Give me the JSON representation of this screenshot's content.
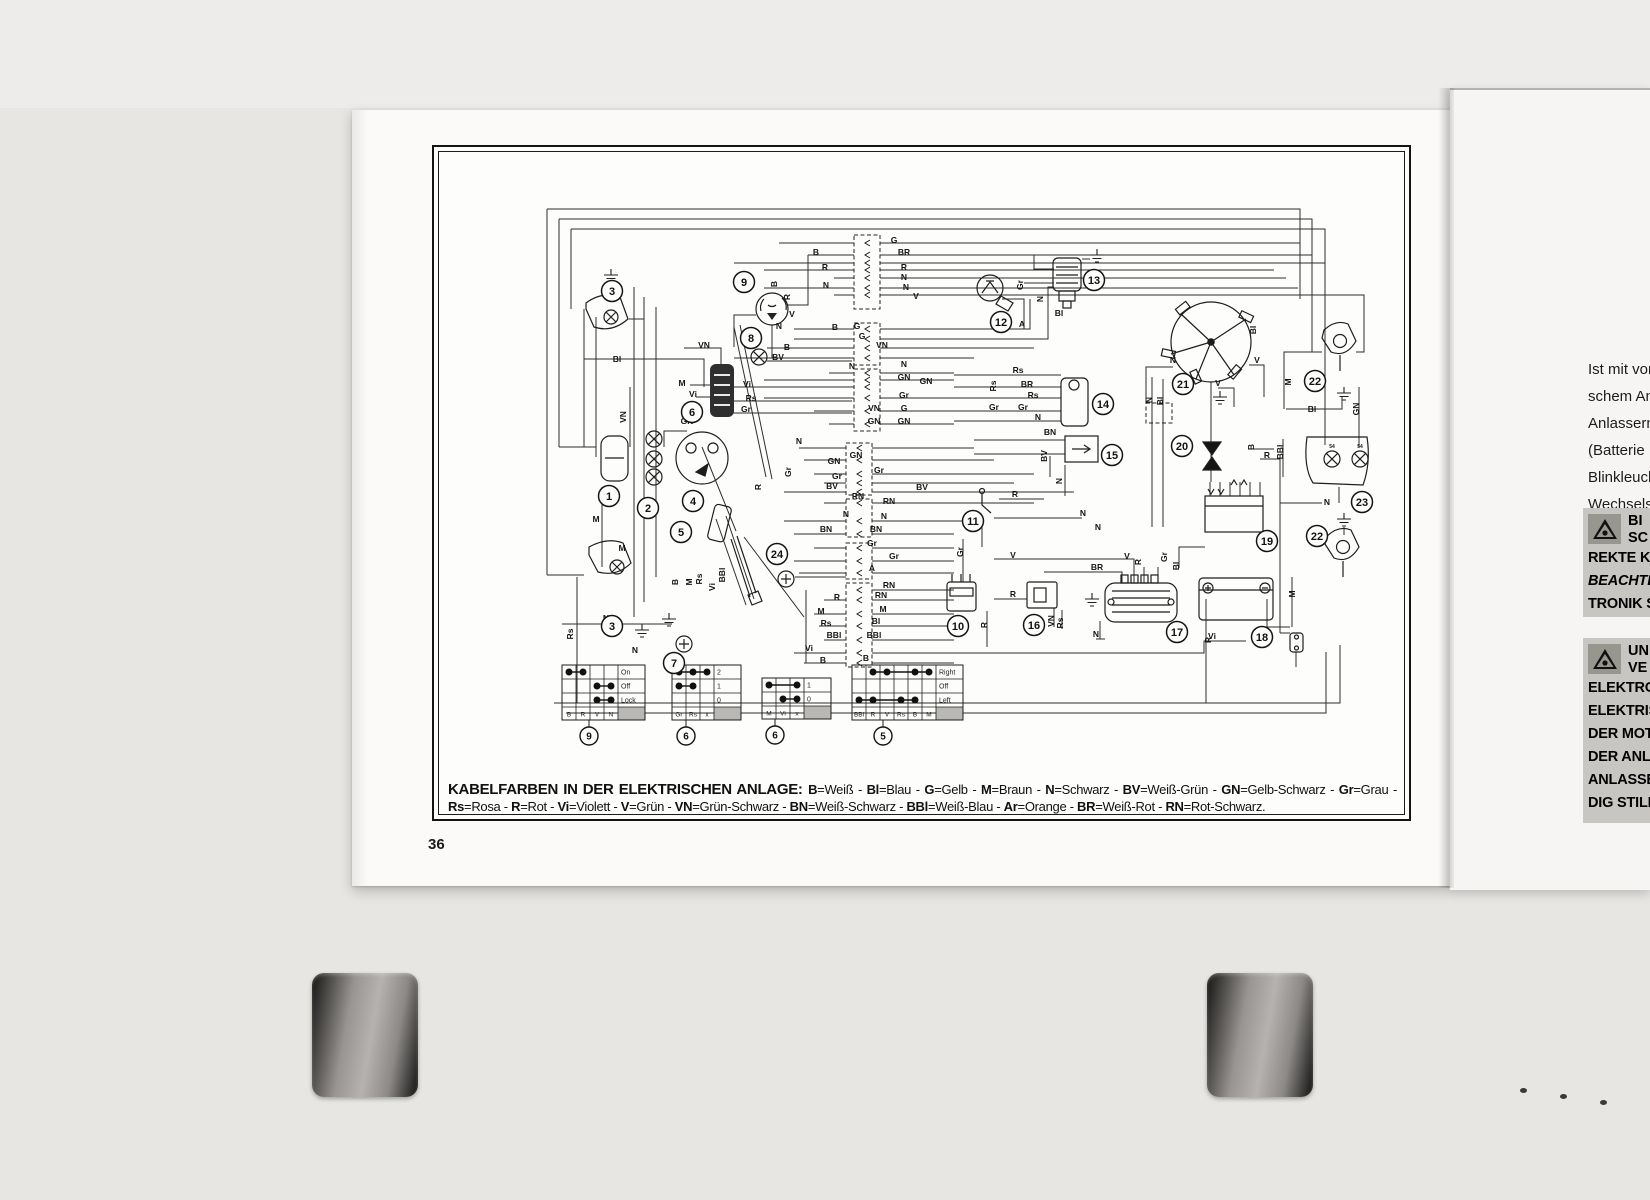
{
  "document": {
    "page_number": "36"
  },
  "diagram": {
    "caption": {
      "heading": "KABELFARBEN IN DER ELEKTRISCHEN ANLAGE:",
      "separator": " - ",
      "terminator": ".",
      "codes": [
        {
          "code": "B",
          "name": "Weiß"
        },
        {
          "code": "Bl",
          "name": "Blau"
        },
        {
          "code": "G",
          "name": "Gelb"
        },
        {
          "code": "M",
          "name": "Braun"
        },
        {
          "code": "N",
          "name": "Schwarz"
        },
        {
          "code": "BV",
          "name": "Weiß-Grün"
        },
        {
          "code": "GN",
          "name": "Gelb-Schwarz"
        },
        {
          "code": "Gr",
          "name": "Grau"
        },
        {
          "code": "Rs",
          "name": "Rosa"
        },
        {
          "code": "R",
          "name": "Rot"
        },
        {
          "code": "Vi",
          "name": "Violett"
        },
        {
          "code": "V",
          "name": "Grün"
        },
        {
          "code": "VN",
          "name": "Grün-Schwarz"
        },
        {
          "code": "BN",
          "name": "Weiß-Schwarz"
        },
        {
          "code": "BBl",
          "name": "Weiß-Blau"
        },
        {
          "code": "Ar",
          "name": "Orange"
        },
        {
          "code": "BR",
          "name": "Weiß-Rot"
        },
        {
          "code": "RN",
          "name": "Rot-Schwarz"
        }
      ]
    },
    "component_markers": [
      {
        "n": "1",
        "x": 175,
        "y": 349
      },
      {
        "n": "2",
        "x": 214,
        "y": 361
      },
      {
        "n": "3",
        "x": 178,
        "y": 144
      },
      {
        "n": "3",
        "x": 178,
        "y": 479
      },
      {
        "n": "4",
        "x": 259,
        "y": 354
      },
      {
        "n": "5",
        "x": 247,
        "y": 385
      },
      {
        "n": "6",
        "x": 258,
        "y": 265
      },
      {
        "n": "7",
        "x": 240,
        "y": 516
      },
      {
        "n": "8",
        "x": 317,
        "y": 191
      },
      {
        "n": "9",
        "x": 310,
        "y": 135
      },
      {
        "n": "10",
        "x": 524,
        "y": 479
      },
      {
        "n": "11",
        "x": 539,
        "y": 374
      },
      {
        "n": "12",
        "x": 567,
        "y": 175
      },
      {
        "n": "13",
        "x": 660,
        "y": 133
      },
      {
        "n": "14",
        "x": 669,
        "y": 257
      },
      {
        "n": "15",
        "x": 678,
        "y": 308
      },
      {
        "n": "16",
        "x": 600,
        "y": 478
      },
      {
        "n": "17",
        "x": 743,
        "y": 485
      },
      {
        "n": "18",
        "x": 828,
        "y": 490
      },
      {
        "n": "19",
        "x": 833,
        "y": 394
      },
      {
        "n": "20",
        "x": 748,
        "y": 299
      },
      {
        "n": "21",
        "x": 749,
        "y": 237
      },
      {
        "n": "22",
        "x": 881,
        "y": 234
      },
      {
        "n": "22",
        "x": 883,
        "y": 389
      },
      {
        "n": "23",
        "x": 928,
        "y": 355
      },
      {
        "n": "24",
        "x": 343,
        "y": 407
      }
    ],
    "wire_labels": [
      {
        "t": "Bl",
        "x": 183,
        "y": 215
      },
      {
        "t": "VN",
        "x": 192,
        "y": 270,
        "v": 1
      },
      {
        "t": "M",
        "x": 162,
        "y": 375
      },
      {
        "t": "Rs",
        "x": 139,
        "y": 487,
        "v": 1
      },
      {
        "t": "N",
        "x": 172,
        "y": 474
      },
      {
        "t": "M",
        "x": 188,
        "y": 404
      },
      {
        "t": "N",
        "x": 201,
        "y": 506
      },
      {
        "t": "VN",
        "x": 270,
        "y": 201
      },
      {
        "t": "M",
        "x": 248,
        "y": 239
      },
      {
        "t": "Vi",
        "x": 259,
        "y": 250
      },
      {
        "t": "Vi",
        "x": 313,
        "y": 240
      },
      {
        "t": "Rs",
        "x": 317,
        "y": 254
      },
      {
        "t": "Gr",
        "x": 312,
        "y": 265
      },
      {
        "t": "GN",
        "x": 253,
        "y": 277
      },
      {
        "t": "B",
        "x": 244,
        "y": 435,
        "v": 1
      },
      {
        "t": "Rs",
        "x": 268,
        "y": 432,
        "v": 1
      },
      {
        "t": "Vi",
        "x": 281,
        "y": 440,
        "v": 1
      },
      {
        "t": "BBl",
        "x": 291,
        "y": 428,
        "v": 1
      },
      {
        "t": "M",
        "x": 258,
        "y": 435,
        "v": 1
      },
      {
        "t": "R",
        "x": 327,
        "y": 340,
        "v": 1
      },
      {
        "t": "Gr",
        "x": 357,
        "y": 325,
        "v": 1
      },
      {
        "t": "B",
        "x": 343,
        "y": 137,
        "v": 1
      },
      {
        "t": "R",
        "x": 356,
        "y": 150,
        "v": 1
      },
      {
        "t": "G",
        "x": 460,
        "y": 96
      },
      {
        "t": "B",
        "x": 382,
        "y": 108
      },
      {
        "t": "BR",
        "x": 470,
        "y": 108
      },
      {
        "t": "R",
        "x": 391,
        "y": 123
      },
      {
        "t": "R",
        "x": 470,
        "y": 123
      },
      {
        "t": "N",
        "x": 470,
        "y": 133
      },
      {
        "t": "N",
        "x": 392,
        "y": 141
      },
      {
        "t": "N",
        "x": 472,
        "y": 143
      },
      {
        "t": "V",
        "x": 482,
        "y": 152
      },
      {
        "t": "V",
        "x": 358,
        "y": 170
      },
      {
        "t": "N",
        "x": 345,
        "y": 182
      },
      {
        "t": "B",
        "x": 401,
        "y": 183
      },
      {
        "t": "G",
        "x": 423,
        "y": 182
      },
      {
        "t": "G",
        "x": 428,
        "y": 192
      },
      {
        "t": "VN",
        "x": 448,
        "y": 201
      },
      {
        "t": "B",
        "x": 353,
        "y": 203
      },
      {
        "t": "BV",
        "x": 344,
        "y": 213
      },
      {
        "t": "N",
        "x": 418,
        "y": 222
      },
      {
        "t": "N",
        "x": 470,
        "y": 220
      },
      {
        "t": "GN",
        "x": 470,
        "y": 233
      },
      {
        "t": "GN",
        "x": 492,
        "y": 237
      },
      {
        "t": "Gr",
        "x": 470,
        "y": 251
      },
      {
        "t": "VN",
        "x": 440,
        "y": 264
      },
      {
        "t": "G",
        "x": 470,
        "y": 264
      },
      {
        "t": "GN",
        "x": 440,
        "y": 277
      },
      {
        "t": "GN",
        "x": 470,
        "y": 277
      },
      {
        "t": "N",
        "x": 365,
        "y": 297
      },
      {
        "t": "GN",
        "x": 400,
        "y": 317
      },
      {
        "t": "GN",
        "x": 422,
        "y": 311
      },
      {
        "t": "Gr",
        "x": 403,
        "y": 332
      },
      {
        "t": "Gr",
        "x": 445,
        "y": 326
      },
      {
        "t": "BV",
        "x": 398,
        "y": 342
      },
      {
        "t": "BV",
        "x": 488,
        "y": 343
      },
      {
        "t": "RN",
        "x": 424,
        "y": 352
      },
      {
        "t": "RN",
        "x": 455,
        "y": 357
      },
      {
        "t": "N",
        "x": 412,
        "y": 370
      },
      {
        "t": "N",
        "x": 450,
        "y": 372
      },
      {
        "t": "BN",
        "x": 392,
        "y": 385
      },
      {
        "t": "BN",
        "x": 442,
        "y": 385
      },
      {
        "t": "Gr",
        "x": 438,
        "y": 399
      },
      {
        "t": "Gr",
        "x": 460,
        "y": 412
      },
      {
        "t": "A",
        "x": 438,
        "y": 424
      },
      {
        "t": "RN",
        "x": 455,
        "y": 441
      },
      {
        "t": "R",
        "x": 403,
        "y": 453
      },
      {
        "t": "RN",
        "x": 447,
        "y": 451
      },
      {
        "t": "M",
        "x": 387,
        "y": 467
      },
      {
        "t": "M",
        "x": 449,
        "y": 465
      },
      {
        "t": "Rs",
        "x": 392,
        "y": 479
      },
      {
        "t": "Bl",
        "x": 442,
        "y": 477
      },
      {
        "t": "BBl",
        "x": 400,
        "y": 491
      },
      {
        "t": "BBl",
        "x": 440,
        "y": 491
      },
      {
        "t": "Vi",
        "x": 375,
        "y": 504
      },
      {
        "t": "B",
        "x": 389,
        "y": 516
      },
      {
        "t": "B",
        "x": 432,
        "y": 514
      },
      {
        "t": "Gr",
        "x": 589,
        "y": 138,
        "v": 1
      },
      {
        "t": "N",
        "x": 609,
        "y": 152,
        "v": 1
      },
      {
        "t": "Bl",
        "x": 625,
        "y": 169
      },
      {
        "t": "A",
        "x": 588,
        "y": 180
      },
      {
        "t": "Rs",
        "x": 584,
        "y": 226
      },
      {
        "t": "Rs",
        "x": 562,
        "y": 239,
        "v": 1
      },
      {
        "t": "BR",
        "x": 593,
        "y": 240
      },
      {
        "t": "Rs",
        "x": 599,
        "y": 251
      },
      {
        "t": "Gr",
        "x": 560,
        "y": 263
      },
      {
        "t": "Gr",
        "x": 589,
        "y": 263
      },
      {
        "t": "N",
        "x": 604,
        "y": 273
      },
      {
        "t": "BN",
        "x": 616,
        "y": 288
      },
      {
        "t": "BV",
        "x": 613,
        "y": 309,
        "v": 1
      },
      {
        "t": "N",
        "x": 628,
        "y": 334,
        "v": 1
      },
      {
        "t": "R",
        "x": 581,
        "y": 350
      },
      {
        "t": "N",
        "x": 649,
        "y": 369
      },
      {
        "t": "N",
        "x": 664,
        "y": 383
      },
      {
        "t": "Gr",
        "x": 529,
        "y": 405,
        "v": 1
      },
      {
        "t": "V",
        "x": 579,
        "y": 411
      },
      {
        "t": "V",
        "x": 693,
        "y": 412
      },
      {
        "t": "R",
        "x": 707,
        "y": 415,
        "v": 1
      },
      {
        "t": "Gr",
        "x": 733,
        "y": 410,
        "v": 1
      },
      {
        "t": "BR",
        "x": 663,
        "y": 423
      },
      {
        "t": "Bl",
        "x": 745,
        "y": 419,
        "v": 1
      },
      {
        "t": "R",
        "x": 579,
        "y": 450
      },
      {
        "t": "R",
        "x": 553,
        "y": 478,
        "v": 1
      },
      {
        "t": "VN",
        "x": 620,
        "y": 474,
        "v": 1
      },
      {
        "t": "Rs",
        "x": 629,
        "y": 476,
        "v": 1
      },
      {
        "t": "N",
        "x": 662,
        "y": 490
      },
      {
        "t": "R",
        "x": 777,
        "y": 493,
        "v": 1
      },
      {
        "t": "B",
        "x": 820,
        "y": 300,
        "v": 1
      },
      {
        "t": "R",
        "x": 833,
        "y": 311
      },
      {
        "t": "N",
        "x": 739,
        "y": 216
      },
      {
        "t": "V",
        "x": 823,
        "y": 216
      },
      {
        "t": "V",
        "x": 784,
        "y": 239
      },
      {
        "t": "Bl",
        "x": 822,
        "y": 183,
        "v": 1
      },
      {
        "t": "M",
        "x": 857,
        "y": 235,
        "v": 1
      },
      {
        "t": "Bl",
        "x": 878,
        "y": 265
      },
      {
        "t": "GN",
        "x": 925,
        "y": 262,
        "v": 1
      },
      {
        "t": "BBl",
        "x": 849,
        "y": 305,
        "v": 1
      },
      {
        "t": "N",
        "x": 893,
        "y": 358
      },
      {
        "t": "M",
        "x": 861,
        "y": 447,
        "v": 1
      },
      {
        "t": "N",
        "x": 718,
        "y": 253,
        "v": 1
      },
      {
        "t": "Bl",
        "x": 729,
        "y": 254,
        "v": 1
      },
      {
        "t": "Vi",
        "x": 778,
        "y": 492
      },
      {
        "t": "54",
        "x": 898,
        "y": 301,
        "s": 5
      },
      {
        "t": "54",
        "x": 926,
        "y": 301,
        "s": 5
      }
    ],
    "legend_tables": [
      {
        "x": 128,
        "y": 518,
        "cols": [
          "B",
          "R",
          "V",
          "N"
        ],
        "rows": [
          {
            "label": "On",
            "dots": [
              0,
              1
            ]
          },
          {
            "label": "Off",
            "dots": [
              2,
              3
            ]
          },
          {
            "label": "Lock",
            "dots": [
              2,
              3
            ]
          }
        ],
        "marker": "9",
        "marker_x": 155
      },
      {
        "x": 238,
        "y": 518,
        "cols": [
          "Gr",
          "Rs",
          "x"
        ],
        "rows": [
          {
            "label": "2",
            "dots": [
              0,
              1,
              2
            ]
          },
          {
            "label": "1",
            "dots": [
              0,
              1
            ]
          },
          {
            "label": "0",
            "dots": []
          }
        ],
        "marker": "6",
        "marker_x": 252
      },
      {
        "x": 328,
        "y": 531,
        "cols": [
          "M",
          "Vi",
          "x"
        ],
        "rows": [
          {
            "label": "1",
            "dots": [
              0,
              2
            ]
          },
          {
            "label": "0",
            "dots": [
              1,
              2
            ]
          }
        ],
        "marker": "6",
        "marker_x": 341
      },
      {
        "x": 418,
        "y": 518,
        "cols": [
          "BBl",
          "R",
          "V",
          "Rs",
          "B",
          "M"
        ],
        "rows": [
          {
            "label": "Right",
            "dots": [
              1,
              2,
              4,
              5
            ]
          },
          {
            "label": "Off",
            "dots": []
          },
          {
            "label": "Left",
            "dots": [
              0,
              1,
              3,
              4
            ]
          }
        ],
        "marker": "5",
        "marker_x": 449
      }
    ]
  },
  "right_page": {
    "paragraph_lines": [
      "Ist mit vor",
      "schem Anl",
      "Anlasserm",
      "(Batterie",
      "Blinkleuch",
      "Wechselstr"
    ],
    "warnings": [
      {
        "side_lines": [
          "BI",
          "SC"
        ],
        "lines": [
          {
            "t": "REKTE  K"
          },
          {
            "t": "BEACHTE",
            "em": true
          },
          {
            "t": "TRONIK SE"
          }
        ]
      },
      {
        "side_lines": [
          "UN",
          "VE"
        ],
        "lines": [
          {
            "t": "ELEKTRON"
          },
          {
            "t": "ELEKTRISC"
          },
          {
            "t": "DER MOTO"
          },
          {
            "t": "DER  ANLA"
          },
          {
            "t": "ANLASSERM"
          },
          {
            "t": "DIG STILLS"
          }
        ]
      }
    ]
  }
}
